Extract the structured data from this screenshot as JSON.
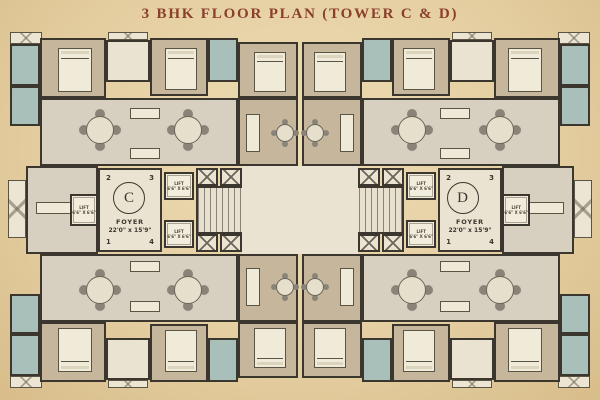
{
  "title": "3 BHK FLOOR PLAN (TOWER C & D)",
  "towers": [
    {
      "letter": "C",
      "foyer": {
        "label": "FOYER",
        "size": "22'0\" x 15'9\""
      },
      "units": {
        "top_left": "2",
        "top_right": "3",
        "bottom_left": "1",
        "bottom_right": "4"
      }
    },
    {
      "letter": "D",
      "foyer": {
        "label": "FOYER",
        "size": "22'0\" x 15'9\""
      },
      "units": {
        "top_left": "2",
        "top_right": "3",
        "bottom_left": "1",
        "bottom_right": "4"
      }
    }
  ],
  "lift": {
    "label": "LIFT",
    "size": "6'6\" X 6'6\""
  },
  "colors": {
    "background": "#e5cfa2",
    "title": "#8a3e2b",
    "wall": "#3b362e",
    "bedroom_floor": "#c6b79c",
    "bathroom_floor": "#a9bfb9",
    "living_floor": "#d7d0c0",
    "foyer_floor": "#eae3d1"
  }
}
